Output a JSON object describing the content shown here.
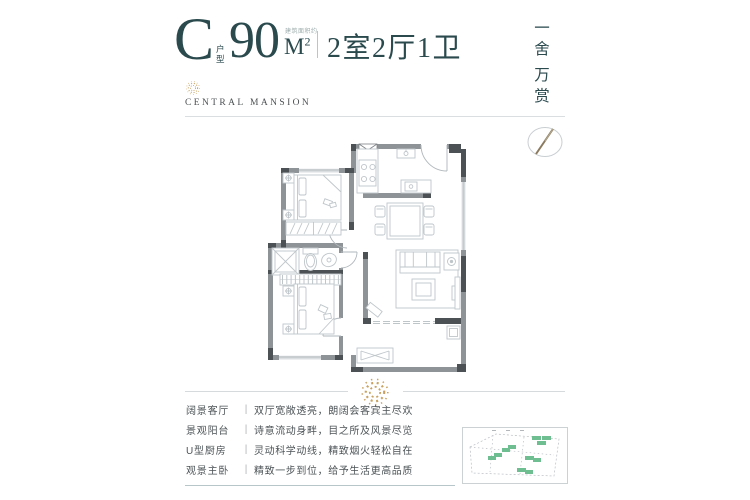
{
  "header": {
    "type_letter": "C",
    "type_suffix": "户型",
    "area_value": "90",
    "area_unit": "M",
    "area_exponent": "2",
    "area_note": "建筑面积约",
    "rooms_text": "2室2厅1卫"
  },
  "brand": {
    "name": "CENTRAL MANSION"
  },
  "slogan": {
    "chars": [
      "一",
      "舍",
      "万",
      "赏"
    ]
  },
  "features": {
    "rows": [
      {
        "label": "阔景客厅",
        "separator": "|",
        "desc": "双厅宽敞透亮，朗阔会客宾主尽欢"
      },
      {
        "label": "景观阳台",
        "separator": "|",
        "desc": "诗意流动身畔，目之所及风景尽览"
      },
      {
        "label": "U型厨房",
        "separator": "|",
        "desc": "灵动科学动线，精致烟火轻松自在"
      },
      {
        "label": "观景主卧",
        "separator": "|",
        "desc": "精致一步到位，给予生活更高品质"
      }
    ]
  },
  "colors": {
    "accent_teal": "#2a4a4e",
    "gold": "#c9a262",
    "wall_gray": "#8e9397",
    "wall_dark": "#4c5155",
    "furniture_line": "#bfc6ca",
    "site_building_green": "#6fbe91"
  }
}
